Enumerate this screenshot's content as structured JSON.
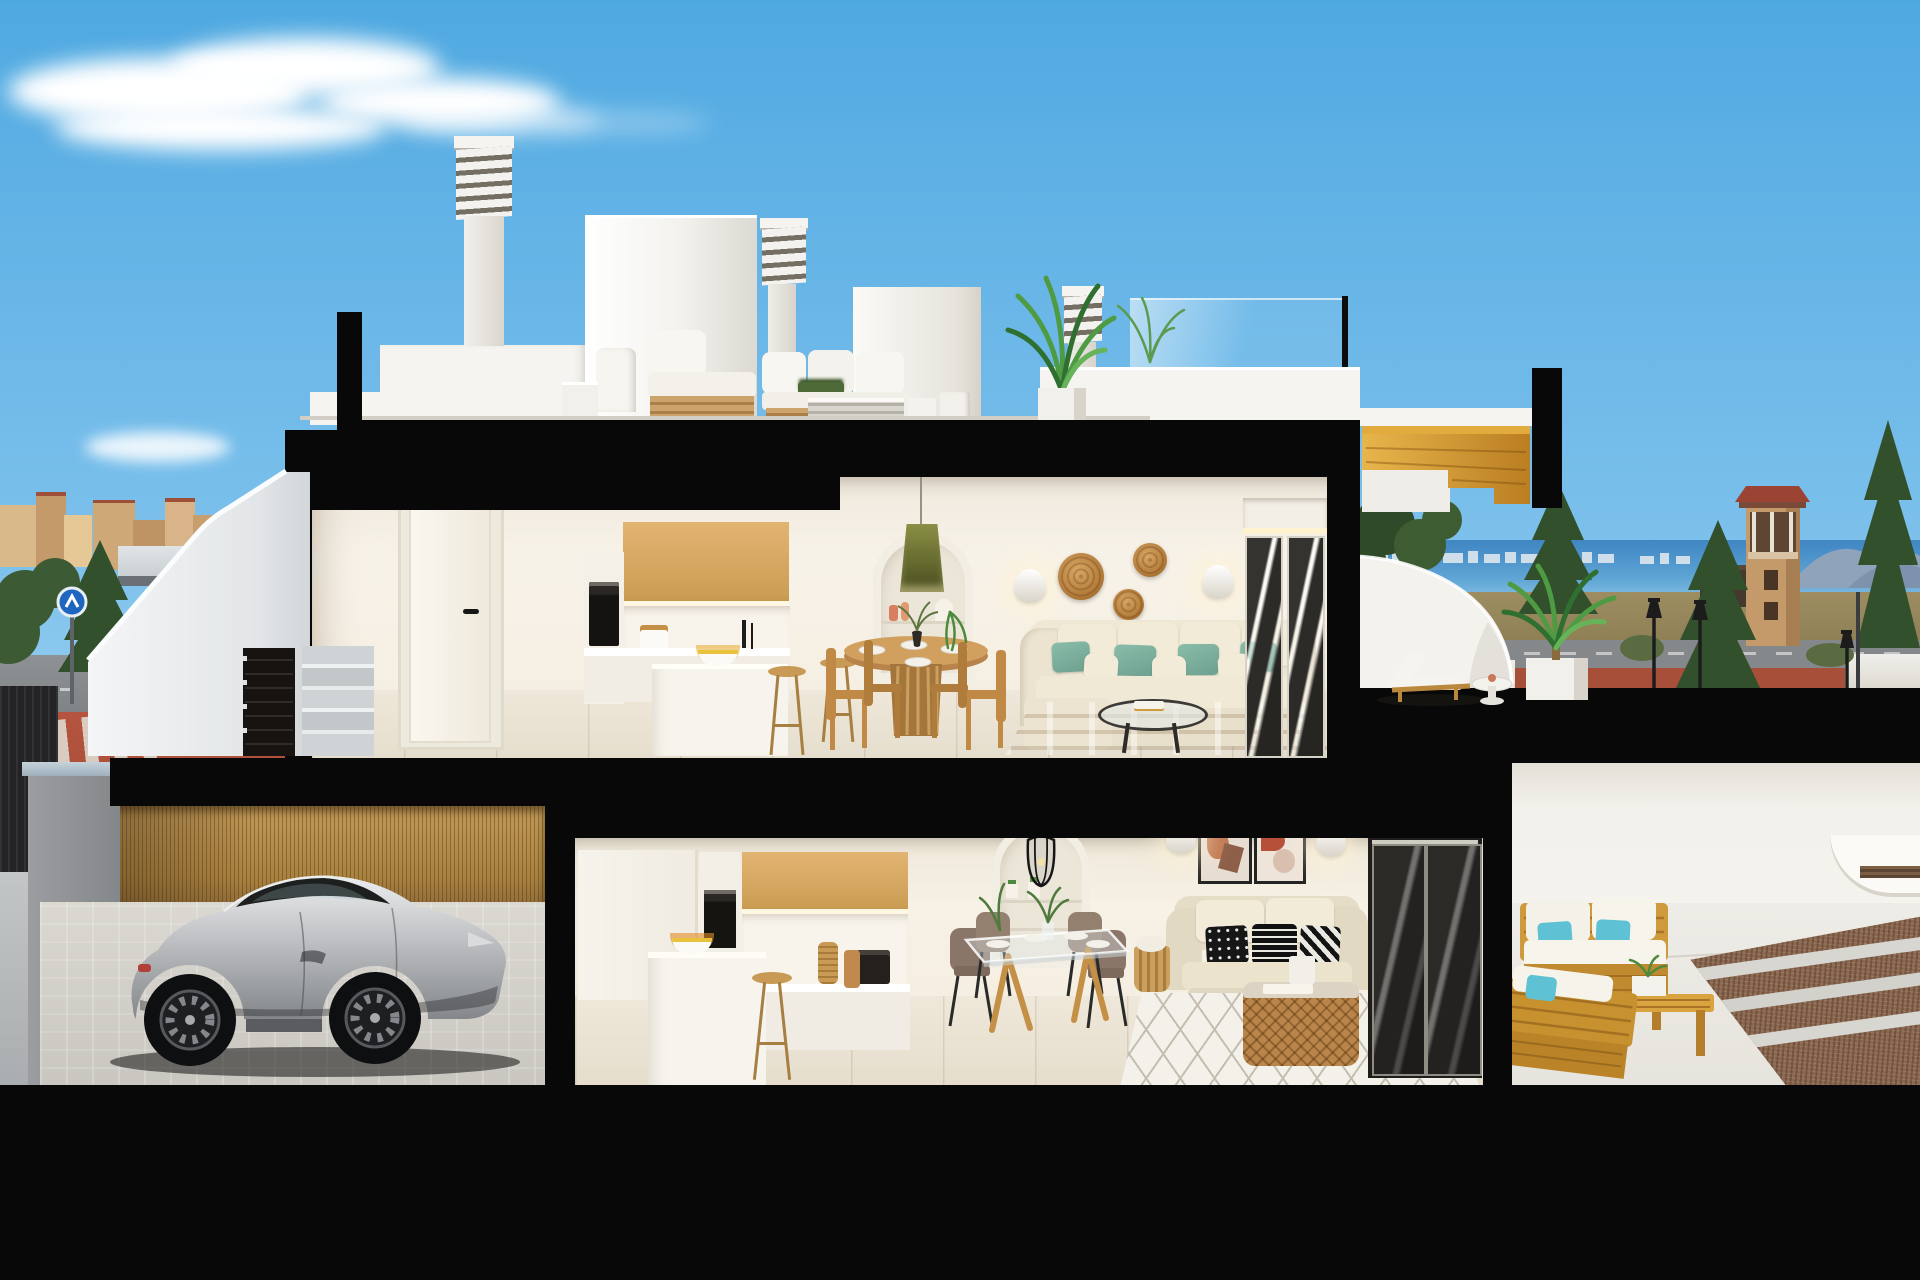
{
  "scene": {
    "title": "Daytime 3D sectional cutaway render of a two-storey white coastal villa with roof terrace, garage with silver sports car, town view left and sea view with watchtower right",
    "type": "architectural cross-section visualization",
    "contains_text": false
  },
  "palette": {
    "sky_top": "#4fa9e1",
    "sky_horizon": "#cfeafa",
    "cut_black": "#080808",
    "wall_white": "#f4f2ed",
    "interior_wall": "#f5efe5",
    "wood_cabinet": "#d7ab66",
    "wood_stair": "#e2ab3d",
    "teak": "#cf9a3c",
    "bamboo": "#bb9154",
    "sofa_cream": "#ece4d1",
    "pillow_teal": "#7fb3a2",
    "pillow_cyan": "#5fc1d4",
    "floor_tile": "#e7e0d2",
    "rug_tan": "#d9c7a3",
    "rug_white": "#f3f0e9",
    "car_silver": "#b9babc",
    "sea": "#4189c6",
    "mountain": "#8fa3bb",
    "town_beige": "#cda379",
    "tree_dark": "#31502b",
    "palm_green": "#4f9b44",
    "pavement_red": "#b0513c",
    "road_grey": "#85898c",
    "tower_tan": "#c59a6a",
    "tower_roof": "#9c4433",
    "field_olive": "#96865c",
    "gravel_brown": "#8a6750",
    "rattan": "#c08a4e"
  },
  "labels": {
    "sky": "Clear blue sky with wispy cirrus cloud",
    "town": "Beige low-rise town skyline with trees, grey road, red pavement and crosswalk",
    "sea_view": "Sea with distant skyline, headland mountains, stone watchtower with red roof, conifers, dry field, street lamps",
    "roof": "Roof terrace: louvered chimney stacks, stair bulkhead, white outdoor lounge set, potted palm, glass railing",
    "upper_floor": "Upper floor: hallway with white door, oak kitchen with island and bar stools, round pedestal dining table, arched niche with olive pendant, cream sofa with teal cushions, rattan wall discs, glass slider",
    "upper_terrace": "Upper sea-view terrace: golden wood stair, curved white parapet, wooden sun lounger, round side table, potted palm",
    "lower_floor": "Lower floor: oak kitchen with oven column and island, glass dining table with taupe chairs, arched niche with wire pendant, beige sofa with black-white cushions, two abstract art prints, rattan drum coffee table, lattice rug, dark glass sliders",
    "lower_terrace": "Lower patio: teak outdoor sofas with white cushions and cyan pillows, teak coffee bench with planter, gravel bed with concrete strips",
    "garage": "Carport: silver sports coupe on pale cobblestone drive, reed privacy fence, grey pillar",
    "exterior_stair": "White exterior stair with concrete steps and dark louvered gate",
    "cuts": "Solid black poche where the structure is sectioned"
  },
  "inventory": {
    "floors": [
      "roof terrace",
      "upper floor",
      "lower floor",
      "garage level"
    ],
    "vehicles": [
      "silver sports coupe facing right"
    ],
    "plants": [
      "roof palm",
      "terrace palm in white planter",
      "niche trailing plants",
      "dining table greenery",
      "background conifers and leafy trees"
    ],
    "furniture_upper": [
      "white door",
      "oak upper cabinets",
      "white island",
      "2 wooden bar stools",
      "round wooden pedestal table",
      "4 wooden chairs",
      "cream 3-seat sofa",
      "4 teal pillows",
      "tan striped rug",
      "round coffee table",
      "2 oval sconces",
      "3 rattan wall discs",
      "olive pendant lamp"
    ],
    "furniture_lower": [
      "oak upper cabinets",
      "oven column",
      "white island with fruit bowl",
      "wooden bar stool",
      "glass dining table",
      "4 taupe chairs",
      "beige 2-seat sofa",
      "3 patterned pillows",
      "2 framed abstract prints",
      "2 oval sconces",
      "black wire pendant",
      "rattan drum coffee table",
      "white diamond-lattice rug",
      "floor basket"
    ],
    "furniture_outdoor": [
      "roof lounge sofa set white",
      "sun lounger with side table",
      "teak sofa",
      "teak bench",
      "teak coffee bench with planter"
    ]
  }
}
